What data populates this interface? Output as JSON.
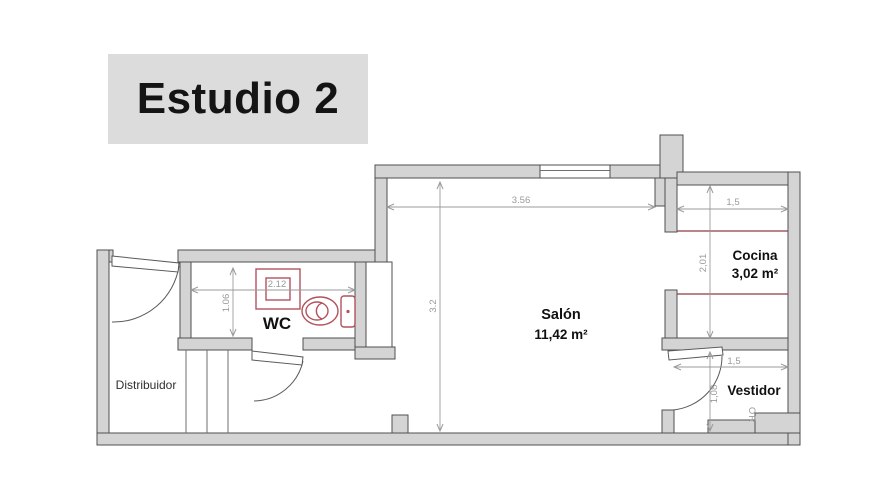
{
  "title": {
    "text": "Estudio 2"
  },
  "plan": {
    "rooms": {
      "distribuidor": {
        "label": "Distribuidor"
      },
      "wc": {
        "label": "WC"
      },
      "salon": {
        "label": "Salón",
        "area": "11,42 m²"
      },
      "cocina": {
        "label": "Cocina",
        "area": "3,02 m²"
      },
      "vestidor": {
        "label": "Vestidor"
      }
    },
    "dimensions": {
      "salon_width": "3.56",
      "salon_depth": "3.2",
      "wc_width": "2.12",
      "wc_depth": "1.06",
      "cocina_width": "1,5",
      "cocina_depth": "2,01",
      "vestidor_width": "1,5",
      "vestidor_depth": "1,08"
    },
    "annotations": {
      "sideways_text": "OR"
    },
    "colors": {
      "title_background": "#dcdcdc",
      "title_text": "#141414",
      "wall_fill": "#d4d4d4",
      "wall_outline": "#4f4f4f",
      "room_label": "#111111",
      "dimension_text": "#9b9b9b",
      "fixture_red": "#b2525d",
      "counter_red": "#8e3b40"
    }
  }
}
